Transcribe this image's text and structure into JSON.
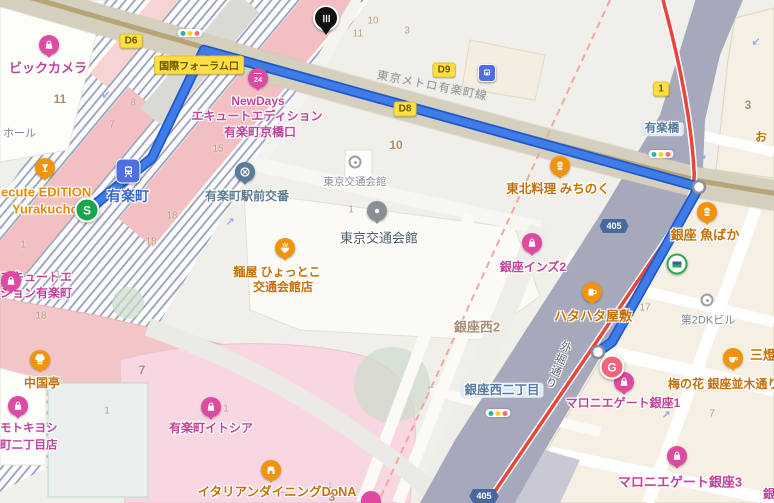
{
  "route": {
    "start": "S",
    "destination": "G"
  },
  "shields": {
    "r405": "405"
  },
  "exits": {
    "d6": "D6",
    "d8": "D8",
    "d9": "D9",
    "e1": "1",
    "kokusai_forum": "国際フォーラム口"
  },
  "transit": {
    "station": "有楽町",
    "metro_line": "東京メトロ有楽町線",
    "bridge": "有楽橋"
  },
  "streets": {
    "sotobori": "外堀通り",
    "ginza_nishi_2chome": "銀座西二丁目",
    "ginza_nishi_2": "銀座西2"
  },
  "places": {
    "bic_camera": "ビックカメラ",
    "hall": "ホール",
    "ecute_line1": "ecute EDITION",
    "ecute_line2": "Yurakucho",
    "newdays_line1": "NewDays",
    "newdays_line2": "エキュートエディション",
    "newdays_line3": "有楽町京橋口",
    "ecute_ed_line1": "エキュートエ",
    "ecute_ed_line2": "ション有楽町",
    "koban": "有楽町駅前交番",
    "kotsu_kaikan_small": "東京交通会館",
    "kotsu_kaikan": "東京交通会館",
    "hyottoko_line1": "麺屋 ひょっとこ",
    "hyottoko_line2": "交通会館店",
    "michinoku": "東北料理 みちのく",
    "ginza_inz2": "銀座インズ2",
    "sakanabaka": "銀座 魚ばか",
    "hatahata": "ハタハタ屋敷",
    "dai2dk": "第2DKビル",
    "chugokutei": "中国亭",
    "matsumotokiyoshi_line1": "モトキヨシ",
    "matsumotokiyoshi_line2": "町二丁目店",
    "itocia": "有楽町イトシア",
    "dona": "イタリアンダイニングDoNA",
    "marronnier1": "マロニエゲート銀座1",
    "marronnier3": "マロニエゲート銀座3",
    "umenohana": "梅の花 銀座並木通り",
    "santo_partial": "三燈",
    "o_partial": "お",
    "gin_partial": "銀座"
  },
  "block_numbers": [
    {
      "v": "11",
      "x": 60,
      "y": 99,
      "b": 1
    },
    {
      "v": "8",
      "x": 133,
      "y": 103
    },
    {
      "v": "7",
      "x": 112,
      "y": 125
    },
    {
      "v": "15",
      "x": 218,
      "y": 149
    },
    {
      "v": "18",
      "x": 172,
      "y": 216
    },
    {
      "v": "18",
      "x": 151,
      "y": 242
    },
    {
      "v": "18",
      "x": 41,
      "y": 316
    },
    {
      "v": "1",
      "x": 23,
      "y": 245
    },
    {
      "v": "1",
      "x": 58,
      "y": 275
    },
    {
      "v": "10",
      "x": 373,
      "y": 21
    },
    {
      "v": "11",
      "x": 358,
      "y": 34
    },
    {
      "v": "3",
      "x": 407,
      "y": 31
    },
    {
      "v": "10",
      "x": 396,
      "y": 145,
      "b": 1
    },
    {
      "v": "1",
      "x": 351,
      "y": 210
    },
    {
      "v": "17",
      "x": 645,
      "y": 308
    },
    {
      "v": "3",
      "x": 748,
      "y": 105,
      "b": 1
    },
    {
      "v": "7",
      "x": 712,
      "y": 414
    },
    {
      "v": "7",
      "x": 142,
      "y": 370,
      "b": 1
    },
    {
      "v": "1",
      "x": 107,
      "y": 411
    },
    {
      "v": "3",
      "x": 332,
      "y": 497,
      "b": 1
    },
    {
      "v": "1",
      "x": 226,
      "y": 409
    }
  ],
  "arrows": [
    {
      "g": "↙",
      "x": 106,
      "y": 95
    },
    {
      "g": "↗",
      "x": 230,
      "y": 222
    },
    {
      "g": "↙",
      "x": 756,
      "y": 42
    },
    {
      "g": "↗",
      "x": 703,
      "y": 67
    },
    {
      "g": "↘",
      "x": 702,
      "y": 156
    },
    {
      "g": "↑",
      "x": 626,
      "y": 200
    },
    {
      "g": "←",
      "x": 431,
      "y": 386
    },
    {
      "g": "↗",
      "x": 666,
      "y": 415
    },
    {
      "g": "↓",
      "x": 330,
      "y": 485
    },
    {
      "g": "←",
      "x": 284,
      "y": 491
    }
  ],
  "colors": {
    "route_blue": "#3f7ce8",
    "route_casing": "#1d59c9",
    "metro_red": "#e8453c",
    "exit_badge_yellow": "#ffdf43",
    "shopping_pin_pink": "#de4aa2",
    "food_pin_orange": "#f0940f",
    "start_green": "#17a64d",
    "destination_pink": "#f0647c",
    "expressway_gray": "#a6a8bb",
    "jr_stripe": "#98a1c0",
    "platform_pink": "#f2c0c2"
  }
}
